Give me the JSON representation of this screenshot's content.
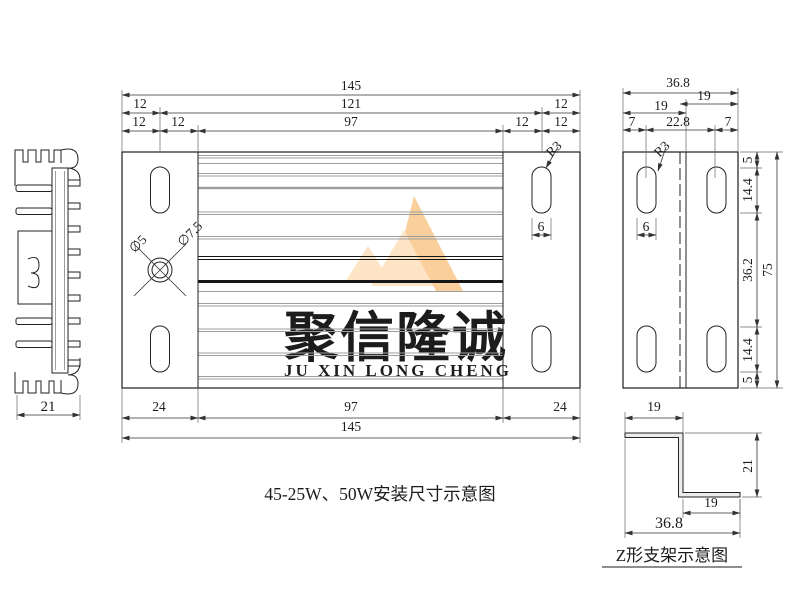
{
  "drawing": {
    "caption_main": "45-25W、50W安装尺寸示意图",
    "caption_bracket": "Z形支架示意图"
  },
  "watermark": {
    "cn": "聚信隆诚",
    "en": "JU XIN LONG CHENG",
    "cn_color": "#dcdcdc",
    "en_color": "#f9d3a2",
    "logo_color_light": "#fde4c4",
    "logo_color_mid": "#fbcf9b"
  },
  "views": {
    "heatsink_profile": {
      "width": "21"
    },
    "plate_top_view": {
      "overall_width": "145",
      "slot_center_span": "121",
      "fin_span": "97",
      "edge_offsets": [
        "12",
        "12",
        "12",
        "12"
      ],
      "bottom_dims": [
        "24",
        "97",
        "24",
        "145"
      ],
      "hole_inner": "∅5",
      "hole_outer": "∅7.5",
      "slot_radius": "R3",
      "slot_width": "6"
    },
    "bracket_plate_view": {
      "overall_width": "36.8",
      "flanges": [
        "19",
        "19"
      ],
      "hole_offsets": [
        "7",
        "22.8",
        "7"
      ],
      "overall_height": "75",
      "height_segments": [
        "5",
        "14.4",
        "36.2",
        "14.4",
        "5"
      ],
      "slot_radius": "R3",
      "slot_width": "6"
    },
    "z_bracket": {
      "top_flange": "19",
      "height": "21",
      "bottom_flange": "19",
      "overall_width": "36.8"
    }
  },
  "plate_fin_lines": [
    {
      "y": 155.5,
      "c": "#9e9e9e",
      "w": 1
    },
    {
      "y": 158,
      "c": "#9e9e9e",
      "w": 1
    },
    {
      "y": 163.5,
      "c": "#9e9e9e",
      "w": 1
    },
    {
      "y": 173.5,
      "c": "#9e9e9e",
      "w": 1
    },
    {
      "y": 176,
      "c": "#9e9e9e",
      "w": 1
    },
    {
      "y": 188,
      "c": "#9e9e9e",
      "w": 2.5
    },
    {
      "y": 212,
      "c": "#9e9e9e",
      "w": 1
    },
    {
      "y": 214.5,
      "c": "#9e9e9e",
      "w": 1
    },
    {
      "y": 236.5,
      "c": "#9e9e9e",
      "w": 1
    },
    {
      "y": 239,
      "c": "#9e9e9e",
      "w": 1
    },
    {
      "y": 256.5,
      "c": "#161616",
      "w": 1
    },
    {
      "y": 259.5,
      "c": "#161616",
      "w": 1
    },
    {
      "y": 281.5,
      "c": "#161616",
      "w": 3
    },
    {
      "y": 291.5,
      "c": "#9e9e9e",
      "w": 1
    },
    {
      "y": 303.5,
      "c": "#9e9e9e",
      "w": 1
    },
    {
      "y": 306,
      "c": "#9e9e9e",
      "w": 1
    },
    {
      "y": 329,
      "c": "#9e9e9e",
      "w": 1
    },
    {
      "y": 331.5,
      "c": "#9e9e9e",
      "w": 1
    },
    {
      "y": 353,
      "c": "#9e9e9e",
      "w": 1
    },
    {
      "y": 355.5,
      "c": "#9e9e9e",
      "w": 1
    },
    {
      "y": 376.5,
      "c": "#9e9e9e",
      "w": 1
    },
    {
      "y": 379,
      "c": "#9e9e9e",
      "w": 1
    }
  ],
  "labels": [
    {
      "n": "dim-plate-overall-width-top",
      "t": "145",
      "x": 351,
      "y": 90
    },
    {
      "n": "dim-plate-left-offset",
      "t": "12",
      "x": 140,
      "y": 108
    },
    {
      "n": "dim-plate-slot-span",
      "t": "121",
      "x": 351,
      "y": 108
    },
    {
      "n": "dim-plate-right-offset",
      "t": "12",
      "x": 561,
      "y": 108
    },
    {
      "n": "dim-plate-left-edge",
      "t": "12",
      "x": 139,
      "y": 126
    },
    {
      "n": "dim-plate-left-inner",
      "t": "12",
      "x": 178,
      "y": 126
    },
    {
      "n": "dim-plate-fin-span-top",
      "t": "97",
      "x": 351,
      "y": 126
    },
    {
      "n": "dim-plate-right-inner",
      "t": "12",
      "x": 522,
      "y": 126
    },
    {
      "n": "dim-plate-right-edge",
      "t": "12",
      "x": 561,
      "y": 126
    },
    {
      "n": "dim-side-overall-width",
      "t": "36.8",
      "x": 678,
      "y": 87
    },
    {
      "n": "dim-side-right-flange",
      "t": "19",
      "x": 704,
      "y": 100
    },
    {
      "n": "dim-side-left-flange",
      "t": "19",
      "x": 661,
      "y": 110
    },
    {
      "n": "dim-side-left-hole-offset",
      "t": "7",
      "x": 632,
      "y": 126
    },
    {
      "n": "dim-side-hole-span",
      "t": "22.8",
      "x": 678,
      "y": 126
    },
    {
      "n": "dim-side-right-hole-offset",
      "t": "7",
      "x": 728,
      "y": 126
    },
    {
      "n": "dim-plate-left-end",
      "t": "24",
      "x": 159,
      "y": 411
    },
    {
      "n": "dim-plate-fin-span-bottom",
      "t": "97",
      "x": 351,
      "y": 411
    },
    {
      "n": "dim-plate-right-end",
      "t": "24",
      "x": 560,
      "y": 411
    },
    {
      "n": "dim-plate-overall-width-bottom",
      "t": "145",
      "x": 351,
      "y": 431
    },
    {
      "n": "dim-side-top-margin",
      "t": "5",
      "x": 752,
      "y": 160,
      "r": -90
    },
    {
      "n": "dim-side-top-slot-offset",
      "t": "14.4",
      "x": 752,
      "y": 190,
      "r": -90
    },
    {
      "n": "dim-side-mid-span",
      "t": "36.2",
      "x": 752,
      "y": 270,
      "r": -90
    },
    {
      "n": "dim-side-bottom-slot-offset",
      "t": "14.4",
      "x": 752,
      "y": 350,
      "r": -90
    },
    {
      "n": "dim-side-bottom-margin",
      "t": "5",
      "x": 752,
      "y": 380,
      "r": -90
    },
    {
      "n": "dim-side-overall-height",
      "t": "75",
      "x": 772,
      "y": 270,
      "r": -90
    },
    {
      "n": "dim-plate-slot-radius",
      "t": "R3",
      "x": 557,
      "y": 152,
      "r": -45
    },
    {
      "n": "dim-plate-slot-width",
      "t": "6",
      "x": 541,
      "y": 231
    },
    {
      "n": "dim-side-slot-radius",
      "t": "R3",
      "x": 665,
      "y": 152,
      "r": -45
    },
    {
      "n": "dim-side-slot-width",
      "t": "6",
      "x": 646,
      "y": 231
    },
    {
      "n": "dim-hole-inner",
      "t": "∅5",
      "x": 141,
      "y": 247,
      "r": -45
    },
    {
      "n": "dim-hole-outer",
      "t": "∅7.5",
      "x": 193,
      "y": 237,
      "r": -45
    },
    {
      "n": "dim-z-top-flange",
      "t": "19",
      "x": 654,
      "y": 411
    },
    {
      "n": "dim-z-height",
      "t": "21",
      "x": 752,
      "y": 466,
      "r": -90
    },
    {
      "n": "dim-z-bottom-flange",
      "t": "19",
      "x": 711,
      "y": 507
    },
    {
      "n": "dim-z-overall-width",
      "t": "36.8",
      "x": 669,
      "y": 528,
      "s": 16
    },
    {
      "n": "dim-profile-width",
      "t": "21",
      "x": 48,
      "y": 411,
      "s": 15
    }
  ]
}
